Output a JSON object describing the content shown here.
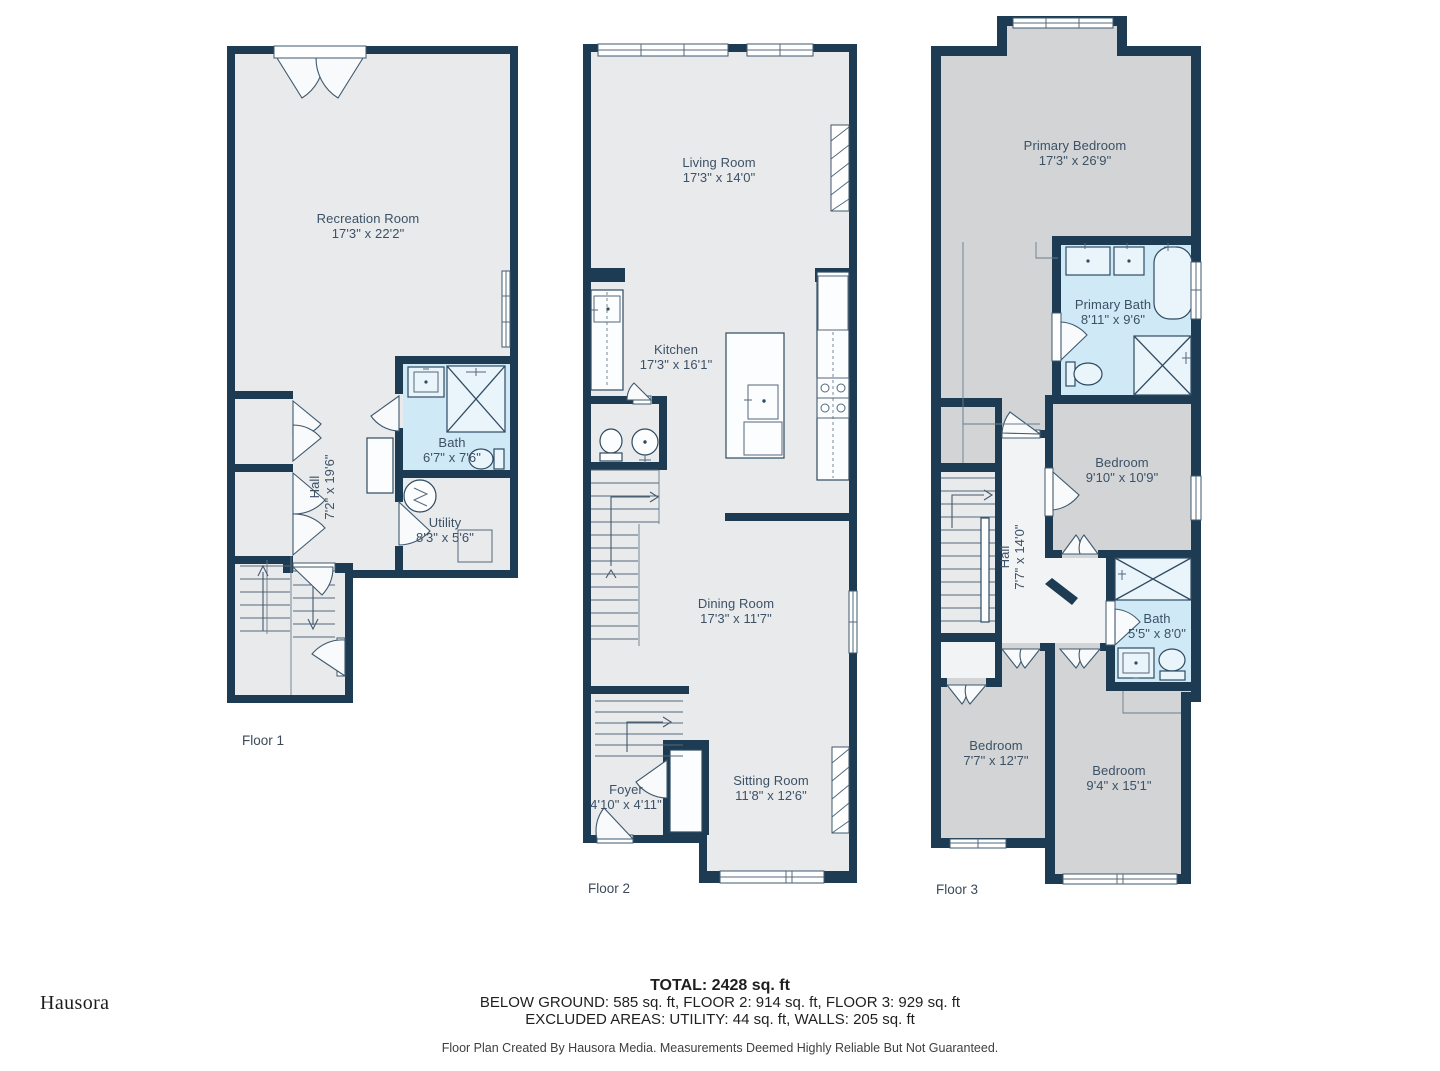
{
  "page": {
    "background": "#ffffff"
  },
  "brand": {
    "logo_text": "Hausora"
  },
  "floors": [
    {
      "label": "Floor 1",
      "rooms": [
        {
          "name": "Recreation Room",
          "dims": "17'3\" x 22'2\""
        },
        {
          "name": "Hall",
          "dims": "7'2\" x 19'6\""
        },
        {
          "name": "Bath",
          "dims": "6'7\" x 7'6\""
        },
        {
          "name": "Utility",
          "dims": "8'3\" x 5'6\""
        }
      ]
    },
    {
      "label": "Floor 2",
      "rooms": [
        {
          "name": "Living Room",
          "dims": "17'3\" x 14'0\""
        },
        {
          "name": "Kitchen",
          "dims": "17'3\" x 16'1\""
        },
        {
          "name": "Dining Room",
          "dims": "17'3\" x 11'7\""
        },
        {
          "name": "Foyer",
          "dims": "4'10\" x 4'11\""
        },
        {
          "name": "Sitting Room",
          "dims": "11'8\" x 12'6\""
        }
      ]
    },
    {
      "label": "Floor 3",
      "rooms": [
        {
          "name": "Primary Bedroom",
          "dims": "17'3\" x 26'9\""
        },
        {
          "name": "Primary Bath",
          "dims": "8'11\" x 9'6\""
        },
        {
          "name": "Bedroom",
          "dims": "9'10\" x 10'9\""
        },
        {
          "name": "Hall",
          "dims": "7'7\" x 14'0\""
        },
        {
          "name": "Bath",
          "dims": "5'5\" x 8'0\""
        },
        {
          "name": "Bedroom",
          "dims": "7'7\" x 12'7\""
        },
        {
          "name": "Bedroom",
          "dims": "9'4\" x 15'1\""
        }
      ]
    }
  ],
  "summary": {
    "total": "TOTAL: 2428 sq. ft",
    "floor_breakdown": "BELOW GROUND: 585 sq. ft, FLOOR 2: 914 sq. ft, FLOOR 3: 929 sq. ft",
    "excluded": "EXCLUDED AREAS: UTILITY: 44 sq. ft, WALLS: 205 sq. ft",
    "disclaimer": "Floor Plan Created By Hausora Media. Measurements Deemed Highly Reliable But Not Guaranteed."
  },
  "colors": {
    "wall": "#1d3b53",
    "floor": "#e9eaec",
    "bedroom_gray": "#d2d4d6",
    "bath_blue": "#cfe9f7",
    "label_text": "#3c5166"
  }
}
